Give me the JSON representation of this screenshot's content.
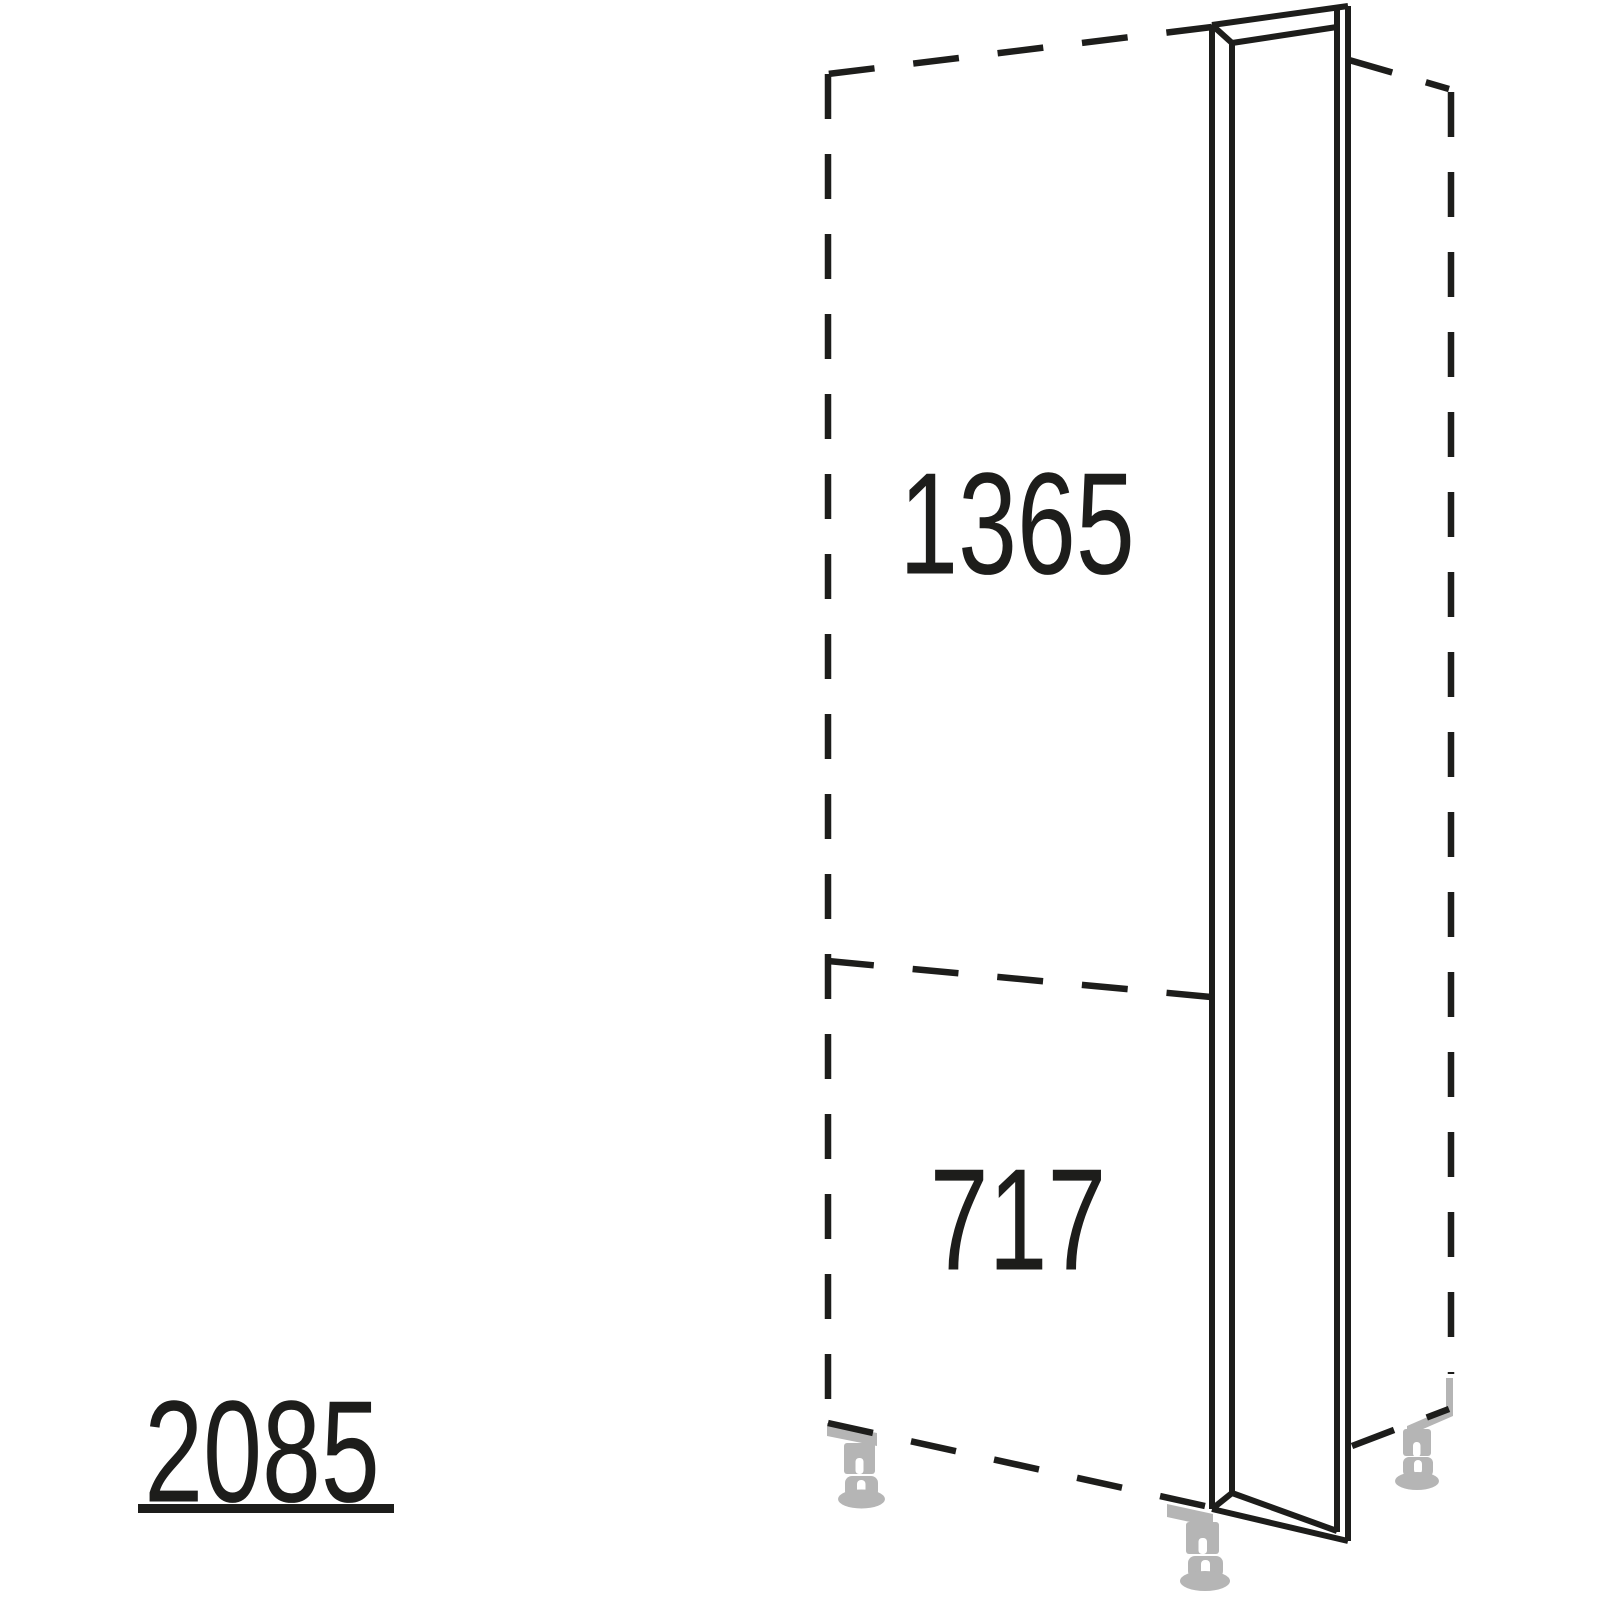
{
  "diagram": {
    "type": "furniture-technical-drawing",
    "labels": {
      "upper_section_height": "1365",
      "lower_section_height": "717",
      "total_height": "2085"
    },
    "colors": {
      "line": "#1d1d1b",
      "foot": "#b5b5b5",
      "background": "#ffffff"
    },
    "parts": {
      "panel": "end-panel",
      "left_outline": "tall-cabinet-dashed-outline",
      "right_outline": "adjacent-cabinet-dashed-outline",
      "divider": "section-divider-dashed-line",
      "feet": "adjustable-plinth-feet"
    }
  }
}
